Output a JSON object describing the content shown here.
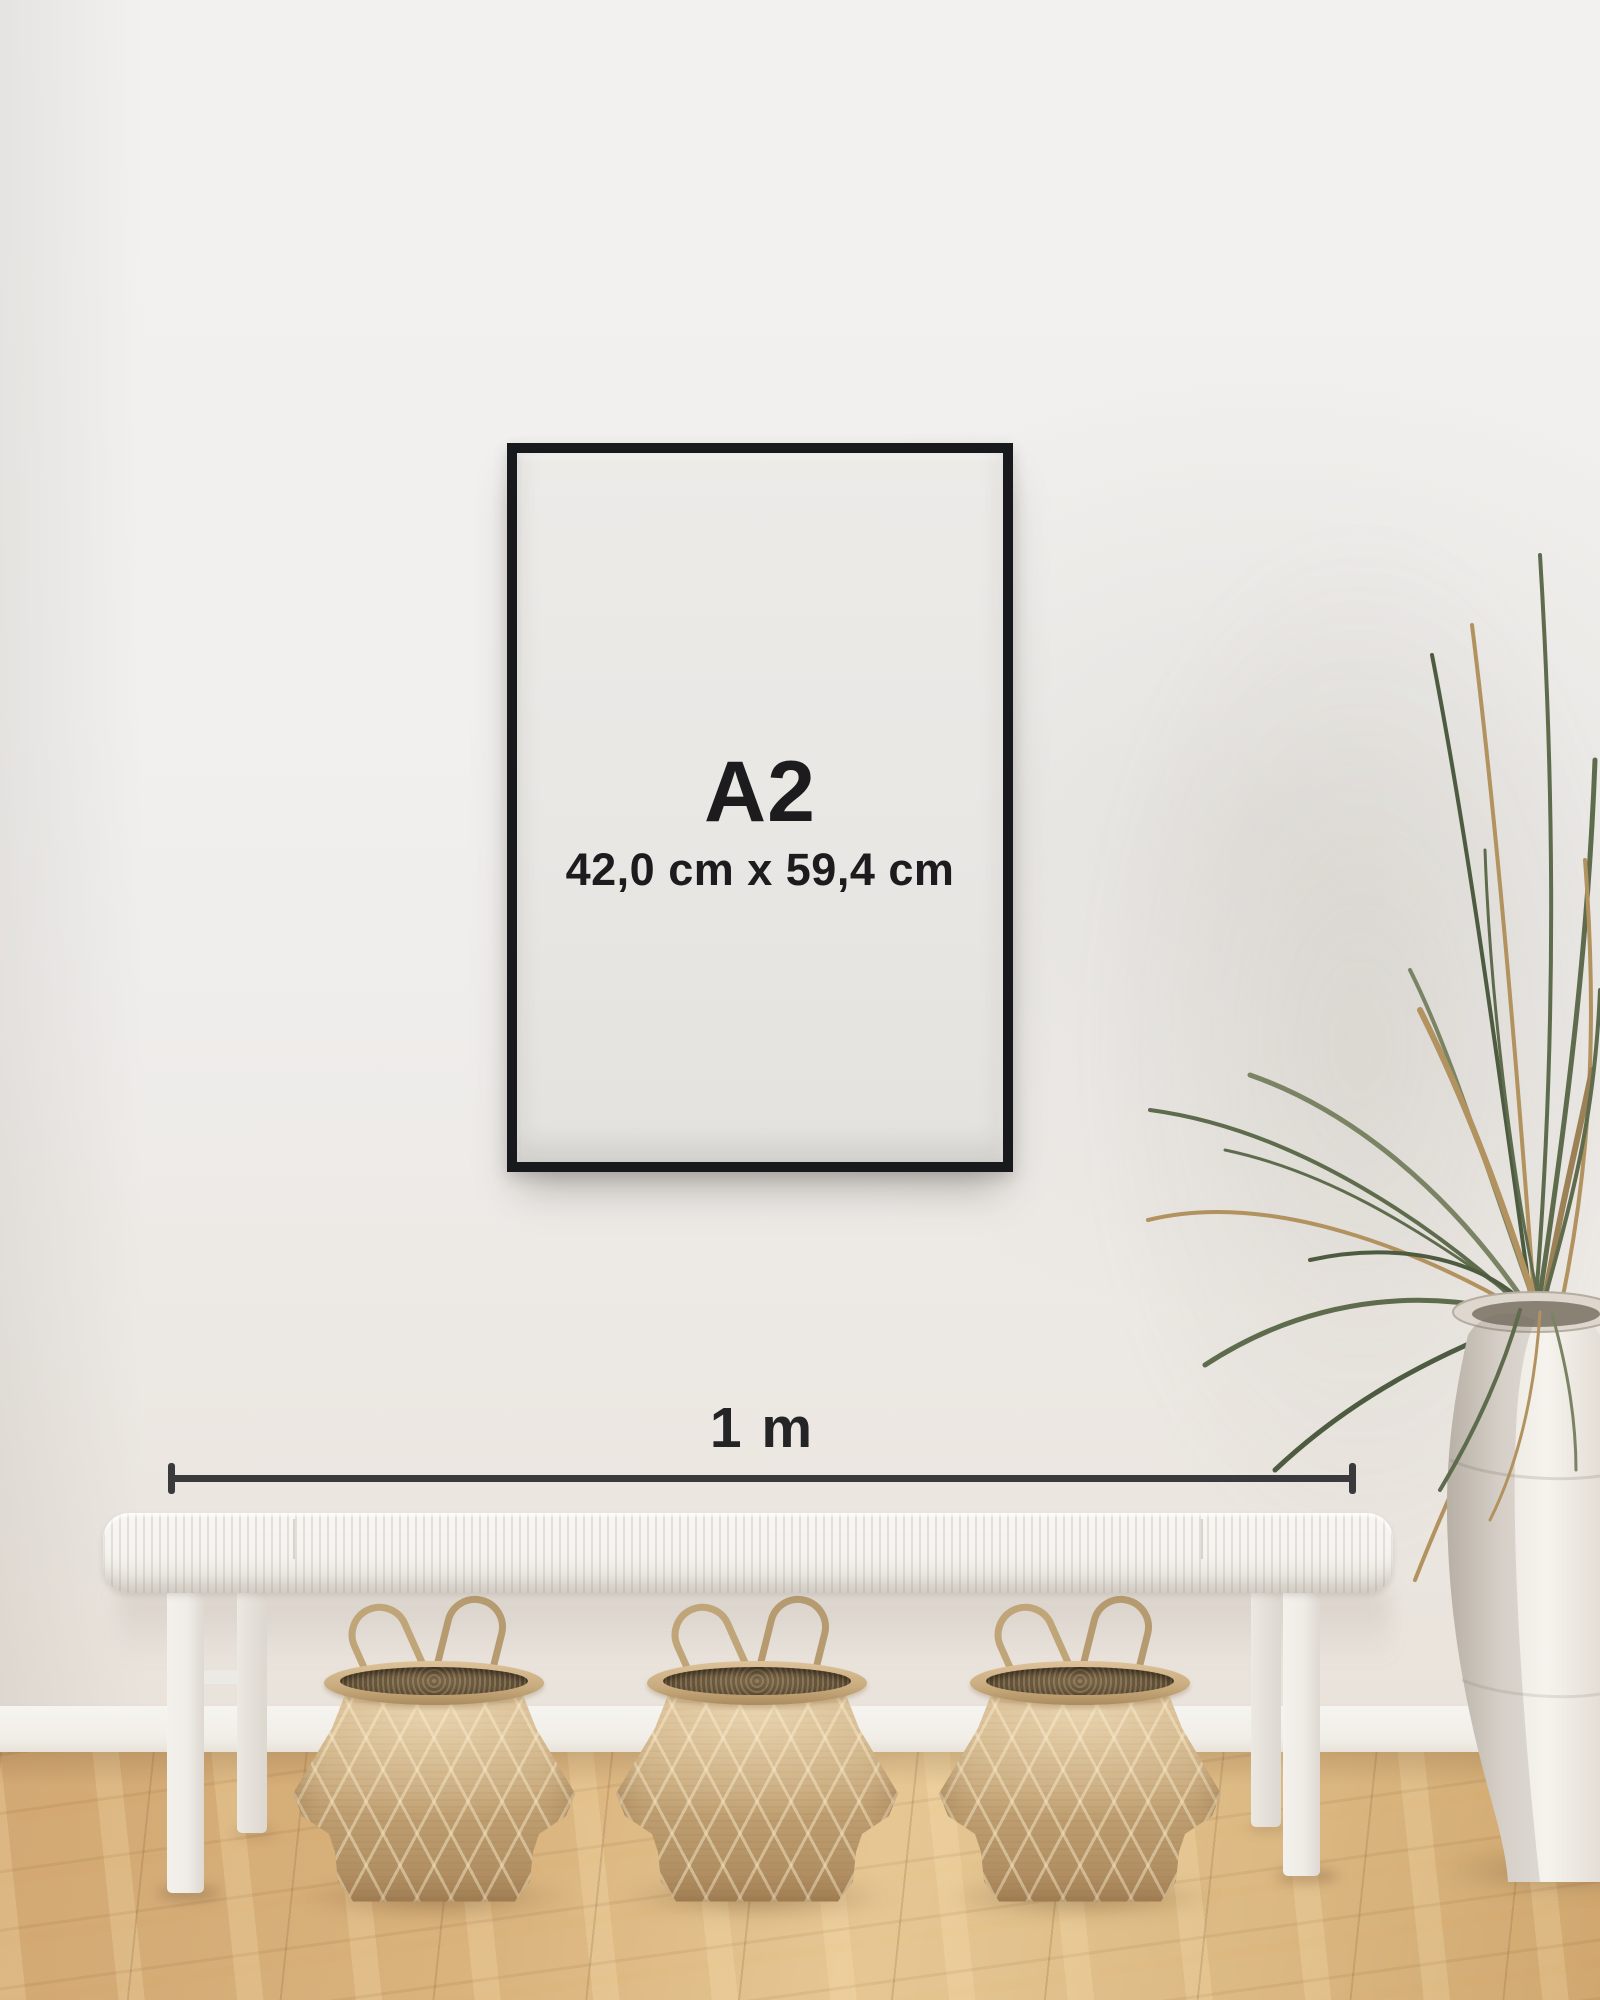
{
  "poster": {
    "size_label": "A2",
    "dimensions": "42,0 cm x 59,4 cm"
  },
  "ruler": {
    "label": "1 m"
  },
  "scene": {
    "objects": [
      "poster-frame",
      "scale-ruler",
      "bench",
      "seagrass-basket",
      "seagrass-basket",
      "seagrass-basket",
      "palm-plant",
      "ceramic-vase",
      "wood-floor",
      "wall"
    ]
  },
  "colors": {
    "wall": "#f1f0ee",
    "wall_warm": "#e9e2da",
    "baseboard": "#f6f4f0",
    "floor_light": "#e6c794",
    "floor_mid": "#d2a873",
    "floor_dark": "#b98e55",
    "frame": "#17191d",
    "paper": "#e9e7e4",
    "text_dark": "#1c1c1e",
    "line": "#3a3a3c",
    "bench": "#f5f3ef",
    "basket_light": "#dec29a",
    "basket_mid": "#c6a678",
    "basket_dark": "#a9855a",
    "plant_green": "#5e6c4d",
    "plant_olive": "#7a8464",
    "plant_dry": "#b2925f",
    "vase_light": "#f2eee8",
    "vase_shade": "#c9c2b7"
  }
}
